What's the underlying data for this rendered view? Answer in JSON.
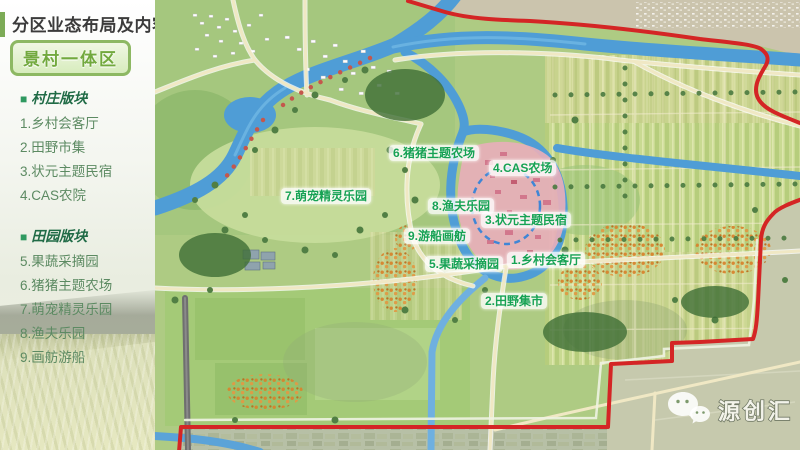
{
  "page": {
    "title": "分区业态布局及内容",
    "zone_badge": "景村一体区"
  },
  "sidebar": {
    "sections": [
      {
        "bullet": "■",
        "header": "村庄版块",
        "items": [
          "1.乡村会客厅",
          "2.田野市集",
          "3.状元主题民宿",
          "4.CAS农院"
        ]
      },
      {
        "bullet": "■",
        "header": "田园版块",
        "items": [
          "5.果蔬采摘园",
          "6.猪猪主题农场",
          "7.萌宠精灵乐园",
          "8.渔夫乐园",
          "9.画舫游船"
        ]
      }
    ]
  },
  "map": {
    "labels": [
      {
        "text": "6.猪猪主题农场"
      },
      {
        "text": "4.CAS农场"
      },
      {
        "text": "7.萌宠精灵乐园"
      },
      {
        "text": "8.渔夫乐园"
      },
      {
        "text": "3.状元主题民宿"
      },
      {
        "text": "9.游船画舫"
      },
      {
        "text": "5.果蔬采摘园"
      },
      {
        "text": "1.乡村会客厅"
      },
      {
        "text": "2.田野集市"
      }
    ],
    "watermark": {
      "icon": "wechat-icon",
      "brand": "源创汇"
    }
  },
  "colors": {
    "accent_green": "#7cab56",
    "badge_green": "#72a93e",
    "label_green": "#17a254",
    "boundary_red": "#d42525",
    "river_blue": "#4f9dd6"
  }
}
